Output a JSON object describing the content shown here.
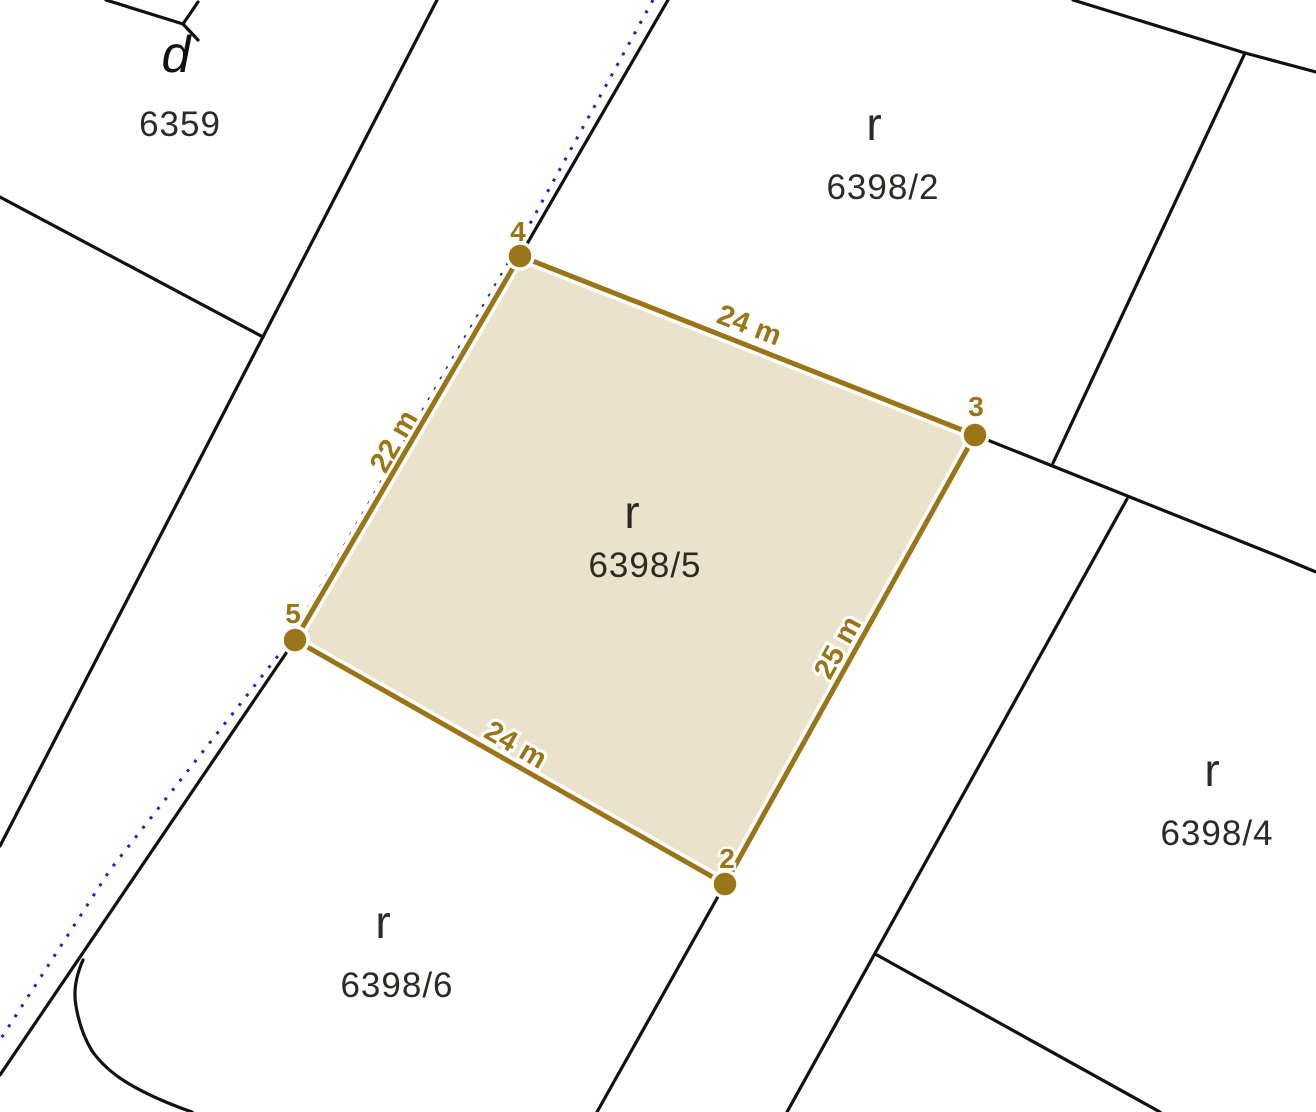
{
  "map": {
    "background_color": "#ffffff",
    "boundary_color": "#111111",
    "easement_color": "#2121c8",
    "parcels": [
      {
        "use_letter": "d",
        "number": "6359"
      },
      {
        "use_letter": "r",
        "number": "6398/2"
      },
      {
        "use_letter": "r",
        "number": "6398/5"
      },
      {
        "use_letter": "r",
        "number": "6398/4"
      },
      {
        "use_letter": "r",
        "number": "6398/6"
      }
    ],
    "highlight": {
      "number": "6398/5",
      "fill": "#eae2cb",
      "stroke": "#9a7517",
      "polygon_points": "520,256 975,435 725,884 295,640",
      "vertices": [
        {
          "id": "2",
          "x": 725,
          "y": 884
        },
        {
          "id": "3",
          "x": 975,
          "y": 435
        },
        {
          "id": "4",
          "x": 520,
          "y": 256
        },
        {
          "id": "5",
          "x": 295,
          "y": 640
        }
      ],
      "measurements": {
        "top": "24 m",
        "left": "22 m",
        "right": "25 m",
        "bottom": "24 m"
      }
    }
  }
}
